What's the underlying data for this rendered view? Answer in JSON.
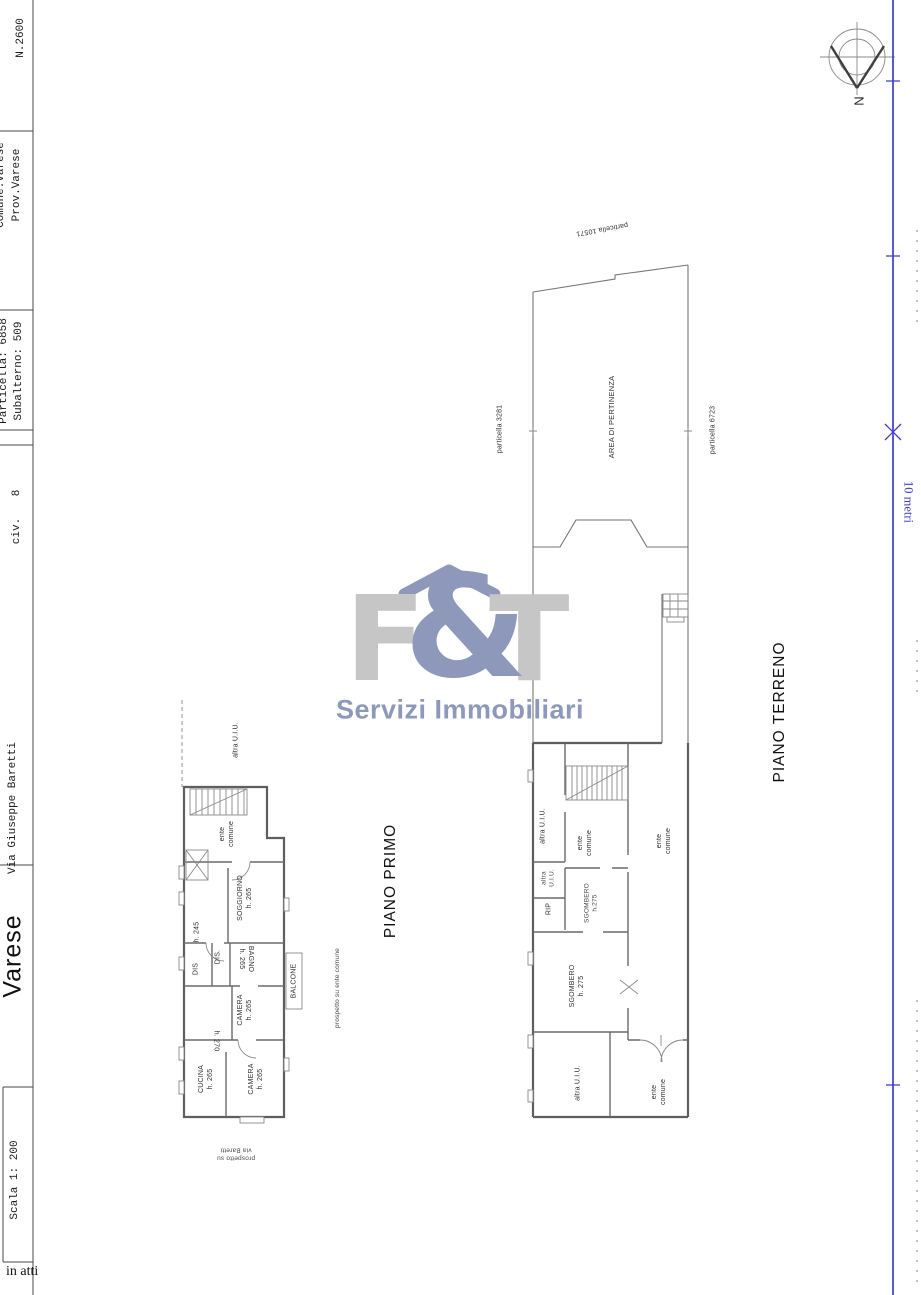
{
  "title_block": {
    "sheet_no": "N.2600",
    "comune_clipped": "Comune:Varese",
    "province": "Prov.Varese",
    "particella": "Particella: 6858",
    "subalterno": "Subalterno: 509",
    "civ": "civ.",
    "civ_no": "8",
    "street": "Via Giuseppe Baretti",
    "city": "Varese",
    "scale": "Scala 1: 200",
    "in_atti": "in atti"
  },
  "compass": {
    "north": "N"
  },
  "scalebar": {
    "label": "10 metri"
  },
  "logo": {
    "f": "F",
    "amp": "&",
    "t": "T",
    "subtitle": "Servizi Immobiliari"
  },
  "piano_primo": {
    "title": "PIANO PRIMO",
    "altra_uiu": "altra U.I.U.",
    "ente_comune": [
      "ente",
      "comune"
    ],
    "soggiorno": [
      "SOGGIORNO",
      "h. 265"
    ],
    "h245": "h. 245",
    "dis1": "DIS.",
    "dis2": "DIS",
    "bagno": [
      "BAGNO",
      "h. 265"
    ],
    "balcone": "BALCONE",
    "camera1": [
      "CAMERA",
      "h. 265"
    ],
    "h270": "h. 270",
    "cucina": [
      "CUCINA",
      "h. 265"
    ],
    "camera2": [
      "CAMERA",
      "h. 265"
    ],
    "prospetto_baretti": [
      "prospetto su",
      "via Baretti"
    ],
    "prospetto_ente": "prospetto su ente comune"
  },
  "piano_terreno": {
    "title": "PIANO TERRENO",
    "particella_10571": "particella 10571",
    "particella_3281": "particella 3281",
    "particella_6723": "particella 6723",
    "area_pertinenza": "AREA DI PERTINENZA",
    "altra_uiu_1": "altra U.I.U.",
    "ente_comune_stair": [
      "ente",
      "comune"
    ],
    "altra_uiu_2": [
      "altra",
      "U.I.U."
    ],
    "rip": "RIP",
    "sgombero_small": [
      "SGOMBERO",
      "h.275"
    ],
    "sgombero_big": [
      "SGOMBERO",
      "h. 275"
    ],
    "ente_comune_corridor": [
      "ente",
      "comune"
    ],
    "altra_uiu_3": "altra U.I.U.",
    "ente_comune_bottom": [
      "ente",
      "comune"
    ]
  },
  "colors": {
    "accent_blue": "#3c3cc8",
    "logo_gray": "#c6c6c7",
    "logo_blue": "#8d98ba"
  }
}
